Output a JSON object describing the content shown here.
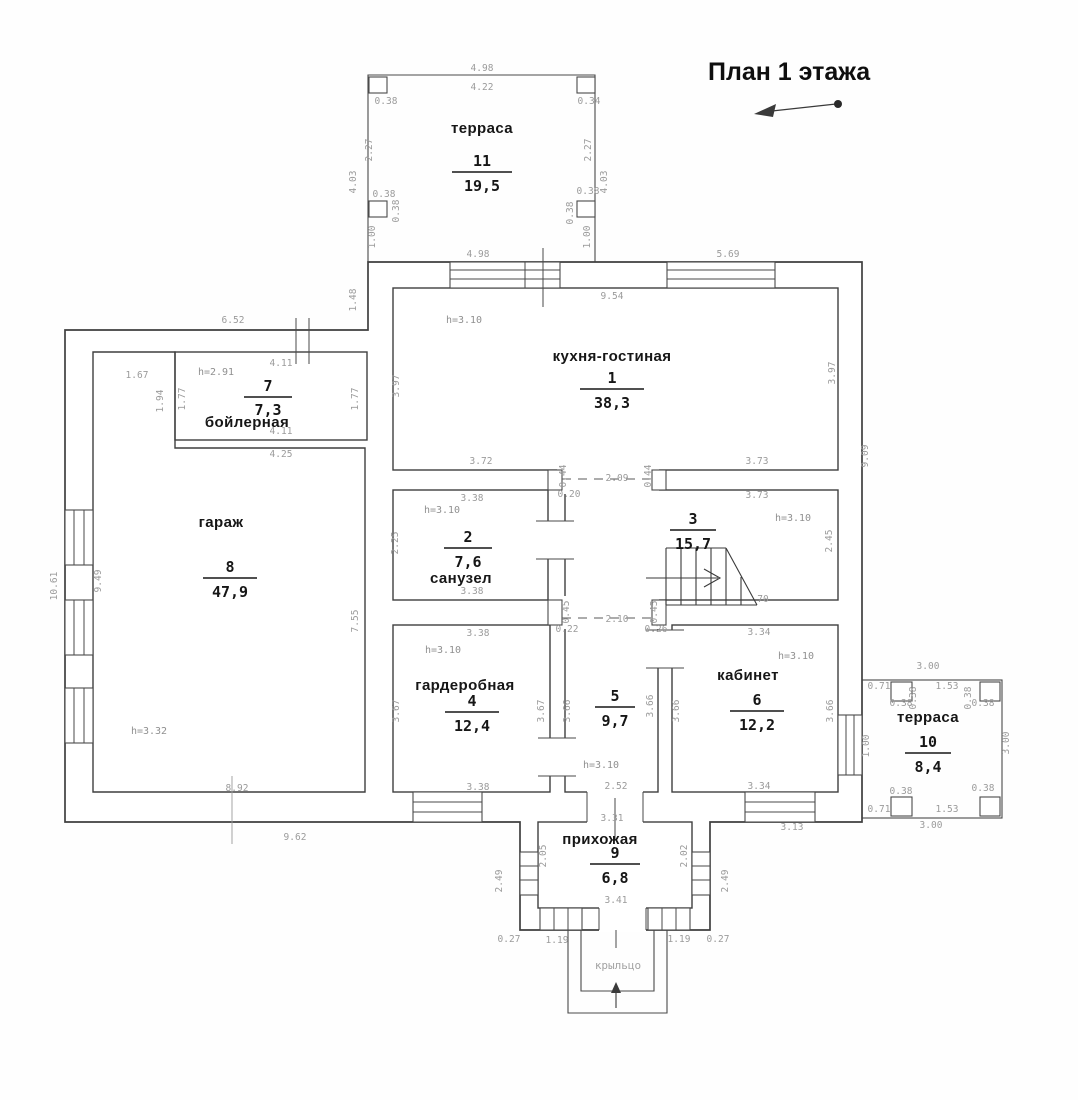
{
  "title": {
    "text": "План 1 этажа"
  },
  "porch": {
    "label": "крыльцо"
  },
  "colors": {
    "wall": "#3f3f3f",
    "dim_text": "#9b9b9b",
    "label_text": "#161616",
    "background": "#fefefe"
  },
  "icons": {
    "north_arrow": "north-arrow",
    "stairs_direction": "stairs-up-arrow",
    "entrance": "entrance-arrow"
  },
  "rooms": [
    {
      "name": "терраса",
      "number": "11",
      "area": "19,5",
      "name_x": 482,
      "name_y": 133,
      "cx": 482,
      "num_y": 166,
      "area_y": 191,
      "half": 30
    },
    {
      "name": "кухня-гостиная",
      "number": "1",
      "area": "38,3",
      "name_x": 612,
      "name_y": 361,
      "cx": 612,
      "num_y": 383,
      "area_y": 408,
      "half": 32
    },
    {
      "name": "бойлерная",
      "number": "7",
      "area": "7,3",
      "name_x": 247,
      "name_y": 427,
      "cx": 268,
      "num_y": 391,
      "area_y": 415,
      "half": 24
    },
    {
      "name": "санузел",
      "number": "2",
      "area": "7,6",
      "name_x": 461,
      "name_y": 583,
      "cx": 468,
      "num_y": 542,
      "area_y": 567,
      "half": 24
    },
    {
      "name": "",
      "number": "3",
      "area": "15,7",
      "name_x": 0,
      "name_y": 0,
      "cx": 693,
      "num_y": 524,
      "area_y": 549,
      "half": 23
    },
    {
      "name": "гардеробная",
      "number": "4",
      "area": "12,4",
      "name_x": 465,
      "name_y": 690,
      "cx": 472,
      "num_y": 706,
      "area_y": 731,
      "half": 27
    },
    {
      "name": "",
      "number": "5",
      "area": "9,7",
      "name_x": 0,
      "name_y": 0,
      "cx": 615,
      "num_y": 701,
      "area_y": 726,
      "half": 20
    },
    {
      "name": "кабинет",
      "number": "6",
      "area": "12,2",
      "name_x": 748,
      "name_y": 680,
      "cx": 757,
      "num_y": 705,
      "area_y": 730,
      "half": 27
    },
    {
      "name": "гараж",
      "number": "8",
      "area": "47,9",
      "name_x": 221,
      "name_y": 527,
      "cx": 230,
      "num_y": 572,
      "area_y": 597,
      "half": 27
    },
    {
      "name": "прихожая",
      "number": "9",
      "area": "6,8",
      "name_x": 600,
      "name_y": 844,
      "cx": 615,
      "num_y": 858,
      "area_y": 883,
      "half": 25
    },
    {
      "name": "терраса",
      "number": "10",
      "area": "8,4",
      "name_x": 928,
      "name_y": 722,
      "cx": 928,
      "num_y": 747,
      "area_y": 772,
      "half": 23
    }
  ],
  "height_labels": [
    {
      "t": "h=3.10",
      "x": 464,
      "y": 323
    },
    {
      "t": "h=3.10",
      "x": 793,
      "y": 521
    },
    {
      "t": "h=3.10",
      "x": 442,
      "y": 513
    },
    {
      "t": "h=3.10",
      "x": 443,
      "y": 653
    },
    {
      "t": "h=3.10",
      "x": 601,
      "y": 768
    },
    {
      "t": "h=3.10",
      "x": 796,
      "y": 659
    },
    {
      "t": "h=2.91",
      "x": 216,
      "y": 375
    },
    {
      "t": "h=3.32",
      "x": 149,
      "y": 734
    }
  ],
  "dimensions": [
    {
      "t": "4.98",
      "x": 482,
      "y": 71
    },
    {
      "t": "4.22",
      "x": 482,
      "y": 90
    },
    {
      "t": "0.38",
      "x": 386,
      "y": 104
    },
    {
      "t": "0.34",
      "x": 589,
      "y": 104
    },
    {
      "t": "2.27",
      "x": 372,
      "y": 150,
      "r": -90
    },
    {
      "t": "2.27",
      "x": 591,
      "y": 150,
      "r": -90
    },
    {
      "t": "4.03",
      "x": 356,
      "y": 182,
      "r": -90
    },
    {
      "t": "4.03",
      "x": 607,
      "y": 182,
      "r": -90
    },
    {
      "t": "0.38",
      "x": 384,
      "y": 197
    },
    {
      "t": "0.38",
      "x": 588,
      "y": 194
    },
    {
      "t": "0.38",
      "x": 399,
      "y": 211,
      "r": -90
    },
    {
      "t": "0.38",
      "x": 573,
      "y": 213,
      "r": -90
    },
    {
      "t": "1.00",
      "x": 375,
      "y": 237,
      "r": -90
    },
    {
      "t": "1.00",
      "x": 590,
      "y": 237,
      "r": -90
    },
    {
      "t": "4.98",
      "x": 478,
      "y": 257
    },
    {
      "t": "5.69",
      "x": 728,
      "y": 257
    },
    {
      "t": "9.54",
      "x": 612,
      "y": 299
    },
    {
      "t": "1.48",
      "x": 356,
      "y": 300,
      "r": -90
    },
    {
      "t": "9.09",
      "x": 868,
      "y": 456,
      "r": -90
    },
    {
      "t": "3.97",
      "x": 399,
      "y": 386,
      "r": -90
    },
    {
      "t": "3.97",
      "x": 835,
      "y": 373,
      "r": -90
    },
    {
      "t": "3.72",
      "x": 481,
      "y": 464
    },
    {
      "t": "3.73",
      "x": 757,
      "y": 464
    },
    {
      "t": "0.44",
      "x": 566,
      "y": 476,
      "r": -90
    },
    {
      "t": "0.44",
      "x": 651,
      "y": 476,
      "r": -90
    },
    {
      "t": "2.09",
      "x": 617,
      "y": 481
    },
    {
      "t": "0.20",
      "x": 569,
      "y": 497
    },
    {
      "t": "3.73",
      "x": 757,
      "y": 498
    },
    {
      "t": "2.45",
      "x": 832,
      "y": 541,
      "r": -90
    },
    {
      "t": "70",
      "x": 763,
      "y": 602
    },
    {
      "t": "0.45",
      "x": 569,
      "y": 612,
      "r": -90
    },
    {
      "t": "0.45",
      "x": 657,
      "y": 612,
      "r": -90
    },
    {
      "t": "2.10",
      "x": 617,
      "y": 622
    },
    {
      "t": "3.38",
      "x": 472,
      "y": 501
    },
    {
      "t": "3.38",
      "x": 472,
      "y": 594
    },
    {
      "t": "2.25",
      "x": 398,
      "y": 543,
      "r": -90
    },
    {
      "t": "0.22",
      "x": 567,
      "y": 632
    },
    {
      "t": "0.26",
      "x": 656,
      "y": 632
    },
    {
      "t": "3.38",
      "x": 478,
      "y": 636
    },
    {
      "t": "3.67",
      "x": 399,
      "y": 711,
      "r": -90
    },
    {
      "t": "3.67",
      "x": 544,
      "y": 711,
      "r": -90
    },
    {
      "t": "3.38",
      "x": 478,
      "y": 790
    },
    {
      "t": "3.66",
      "x": 570,
      "y": 711,
      "r": -90
    },
    {
      "t": "3.66",
      "x": 653,
      "y": 706,
      "r": -90
    },
    {
      "t": "2.52",
      "x": 616,
      "y": 789
    },
    {
      "t": "3.34",
      "x": 759,
      "y": 635
    },
    {
      "t": "3.66",
      "x": 679,
      "y": 711,
      "r": -90
    },
    {
      "t": "3.66",
      "x": 833,
      "y": 711,
      "r": -90
    },
    {
      "t": "3.34",
      "x": 759,
      "y": 789
    },
    {
      "t": "3.13",
      "x": 792,
      "y": 830
    },
    {
      "t": "3.00",
      "x": 928,
      "y": 669
    },
    {
      "t": "0.71",
      "x": 879,
      "y": 689
    },
    {
      "t": "1.53",
      "x": 947,
      "y": 689
    },
    {
      "t": "0.38",
      "x": 901,
      "y": 706
    },
    {
      "t": "0.38",
      "x": 983,
      "y": 706
    },
    {
      "t": "0.38",
      "x": 916,
      "y": 698,
      "r": -90
    },
    {
      "t": "0.38",
      "x": 971,
      "y": 698,
      "r": -90
    },
    {
      "t": "1.00",
      "x": 869,
      "y": 746,
      "r": -90
    },
    {
      "t": "3.00",
      "x": 1009,
      "y": 743,
      "r": -90
    },
    {
      "t": "0.38",
      "x": 901,
      "y": 794
    },
    {
      "t": "0.38",
      "x": 983,
      "y": 791
    },
    {
      "t": "0.71",
      "x": 879,
      "y": 812
    },
    {
      "t": "1.53",
      "x": 947,
      "y": 812
    },
    {
      "t": "3.00",
      "x": 931,
      "y": 828
    },
    {
      "t": "6.52",
      "x": 233,
      "y": 323
    },
    {
      "t": "1.67",
      "x": 137,
      "y": 378
    },
    {
      "t": "1.94",
      "x": 163,
      "y": 401,
      "r": -90
    },
    {
      "t": "1.77",
      "x": 185,
      "y": 399,
      "r": -90
    },
    {
      "t": "1.77",
      "x": 358,
      "y": 399,
      "r": -90
    },
    {
      "t": "4.11",
      "x": 281,
      "y": 366
    },
    {
      "t": "4.11",
      "x": 281,
      "y": 434
    },
    {
      "t": "4.25",
      "x": 281,
      "y": 457
    },
    {
      "t": "10.61",
      "x": 57,
      "y": 586,
      "r": -90
    },
    {
      "t": "9.49",
      "x": 101,
      "y": 581,
      "r": -90
    },
    {
      "t": "7.55",
      "x": 358,
      "y": 621,
      "r": -90
    },
    {
      "t": "8.92",
      "x": 237,
      "y": 791
    },
    {
      "t": "9.62",
      "x": 295,
      "y": 840
    },
    {
      "t": "3.31",
      "x": 612,
      "y": 821
    },
    {
      "t": "2.05",
      "x": 546,
      "y": 856,
      "r": -90
    },
    {
      "t": "2.02",
      "x": 687,
      "y": 856,
      "r": -90
    },
    {
      "t": "2.49",
      "x": 502,
      "y": 881,
      "r": -90
    },
    {
      "t": "2.49",
      "x": 728,
      "y": 881,
      "r": -90
    },
    {
      "t": "3.41",
      "x": 616,
      "y": 903
    },
    {
      "t": "0.27",
      "x": 509,
      "y": 942
    },
    {
      "t": "1.19",
      "x": 557,
      "y": 943
    },
    {
      "t": "1.19",
      "x": 679,
      "y": 942
    },
    {
      "t": "0.27",
      "x": 718,
      "y": 942
    }
  ]
}
